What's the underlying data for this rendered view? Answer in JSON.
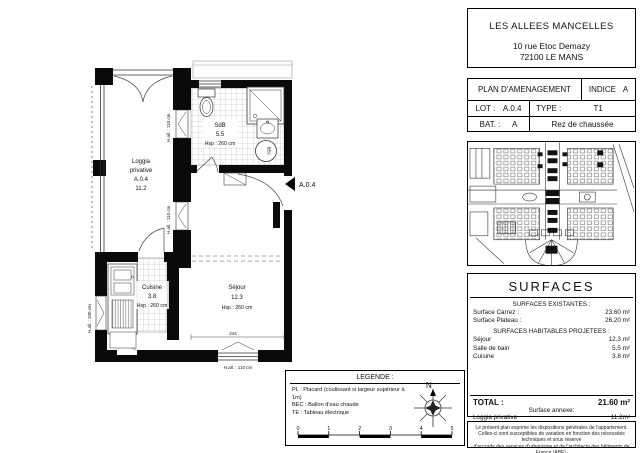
{
  "header": {
    "project": "LES ALLEES MANCELLES",
    "address_line1": "10 rue Etoc Demazy",
    "address_line2": "72100 LE MANS"
  },
  "plan_info": {
    "title": "PLAN D'AMENAGEMENT",
    "indice_label": "INDICE",
    "indice_value": "A",
    "lot_label": "LOT :",
    "lot_value": "A.0.4",
    "type_label": "TYPE :",
    "type_value": "T1",
    "bat_label": "BAT. :",
    "bat_value": "A",
    "floor": "Rez de chaussée"
  },
  "floor_plan": {
    "rooms": {
      "loggia": [
        "Loggia",
        "privative",
        "A.0.4",
        "11.2"
      ],
      "sdb": [
        "SdB",
        "5.5",
        "Hsp : 260 cm"
      ],
      "cuisine": [
        "Cuisine",
        "3.8",
        "Hsp : 260 cm"
      ],
      "sejour": [
        "Séjour",
        "12.3",
        "Hsp : 260 cm"
      ]
    },
    "annotations": {
      "entrance": "A.0.4",
      "hall_110": "H.all. : 110 cm",
      "hall_100": "H.all. : 100 cm",
      "dim_244": "244",
      "bec": "BEC"
    }
  },
  "surfaces": {
    "title": "SURFACES",
    "existantes_header": "SURFACES EXISTANTES :",
    "rows_existantes": [
      {
        "label": "Surface Carrez :",
        "value": "23.60 m²"
      },
      {
        "label": "Surface Plateau :",
        "value": "26.20 m²"
      }
    ],
    "projetees_header": "SURFACES HABITABLES PROJETEES :",
    "rows_projetees": [
      {
        "label": "Séjour",
        "value": "12.3 m²"
      },
      {
        "label": "Salle de bain",
        "value": "5.5 m²"
      },
      {
        "label": "Cuisine",
        "value": "3.8 m²"
      }
    ],
    "total_label": "TOTAL :",
    "total_value": "21.60 m²",
    "annexe_header": "Surface annexe:",
    "annexe_label": "Loggia privative",
    "annexe_value": "11.2m²"
  },
  "legend": {
    "title": "LEGENDE :",
    "items": [
      "PL : Placard (coulissant si largeur supérieur à 1m)",
      "BEC : Ballon d'eau chaude",
      "TE : Tableau électrique"
    ],
    "north_label": "N",
    "scale_ticks": [
      "0",
      "1",
      "2",
      "3",
      "4",
      "5"
    ]
  },
  "disclaimer": {
    "line1": "Le présent plan exprime les dispositions générales de l'appartement.",
    "line2": "Celles-ci sont susceptibles de variation en fonction des nécessités techniques et sous réserve",
    "line3": "d'accords des services d'urbanisme et de l'architecte des bâtiments de France (ABF)."
  },
  "colors": {
    "ink": "#111111",
    "wall": "#0a0a0a",
    "tile_line": "#999999"
  }
}
